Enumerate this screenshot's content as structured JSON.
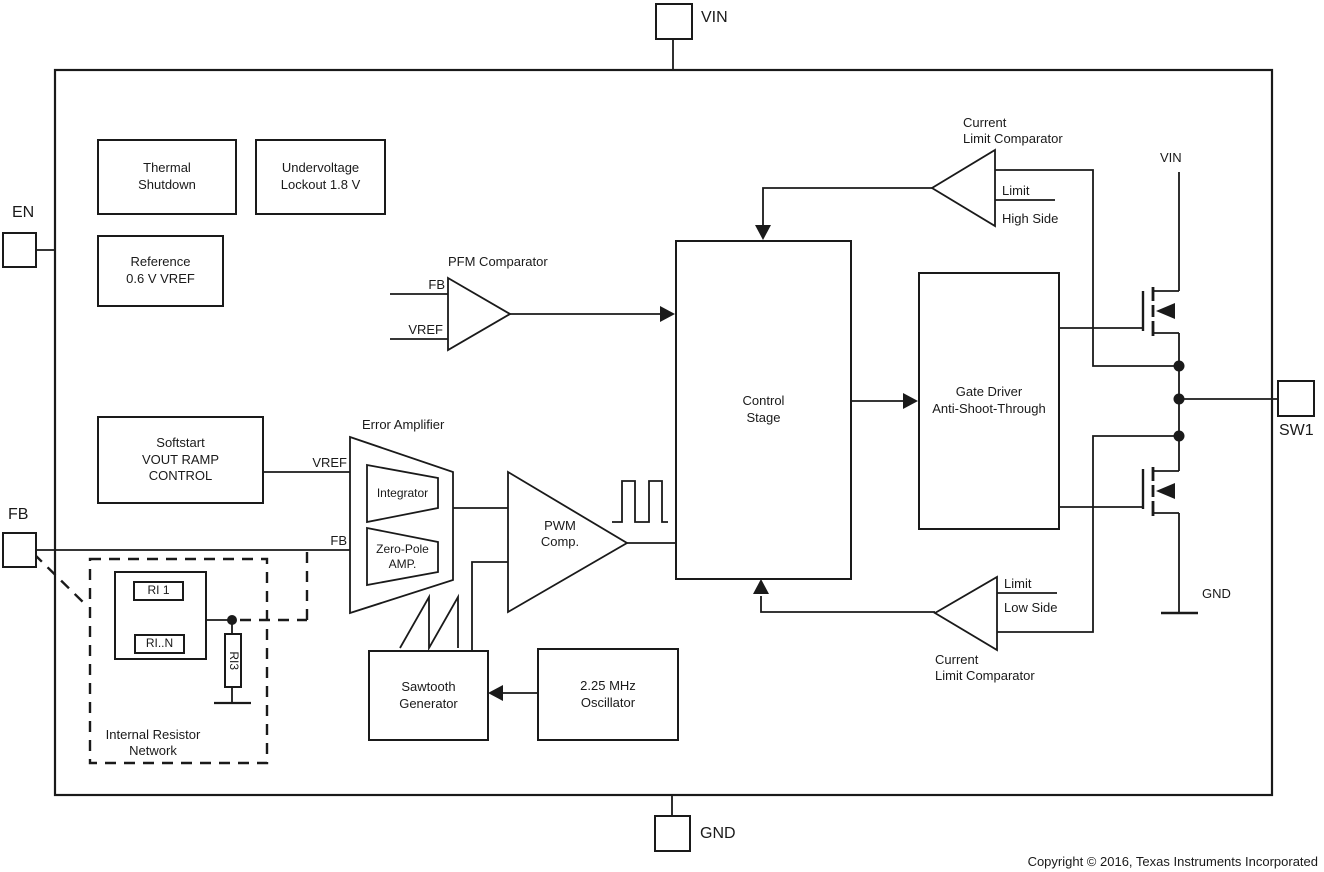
{
  "labels": {
    "pin_vin": "VIN",
    "pin_gnd": "GND",
    "pin_en": "EN",
    "pin_fb": "FB",
    "pin_sw1": "SW1",
    "vin_rail": "VIN",
    "gnd_rail": "GND",
    "thermal_shutdown": "Thermal\nShutdown",
    "undervoltage_lockout": "Undervoltage\nLockout 1.8 V",
    "reference": "Reference\n0.6 V VREF",
    "softstart": "Softstart\nVOUT RAMP\nCONTROL",
    "pfm_comparator_title": "PFM Comparator",
    "pfm_in_fb": "FB",
    "pfm_in_vref": "VREF",
    "error_amplifier_title": "Error Amplifier",
    "ea_in_vref": "VREF",
    "ea_in_fb": "FB",
    "integrator": "Integrator",
    "zero_pole_amp": "Zero-Pole\nAMP.",
    "pwm_comp": "PWM\nComp.",
    "control_stage": "Control\nStage",
    "gate_driver": "Gate Driver\nAnti-Shoot-Through",
    "sawtooth_generator": "Sawtooth\nGenerator",
    "oscillator": "2.25 MHz\nOscillator",
    "cl_top_title": "Current\nLimit Comparator",
    "cl_top_limit": "Limit",
    "cl_top_side": "High Side",
    "cl_bottom_limit": "Limit",
    "cl_bottom_side": "Low Side",
    "cl_bottom_title": "Current\nLimit Comparator",
    "ri1": "RI 1",
    "rin": "RI..N",
    "ri3": "RI3",
    "resistor_network": "Internal Resistor\nNetwork",
    "copyright": "Copyright © 2016, Texas Instruments Incorporated"
  },
  "colors": {
    "line": "#1a1a1a",
    "background": "#ffffff"
  }
}
